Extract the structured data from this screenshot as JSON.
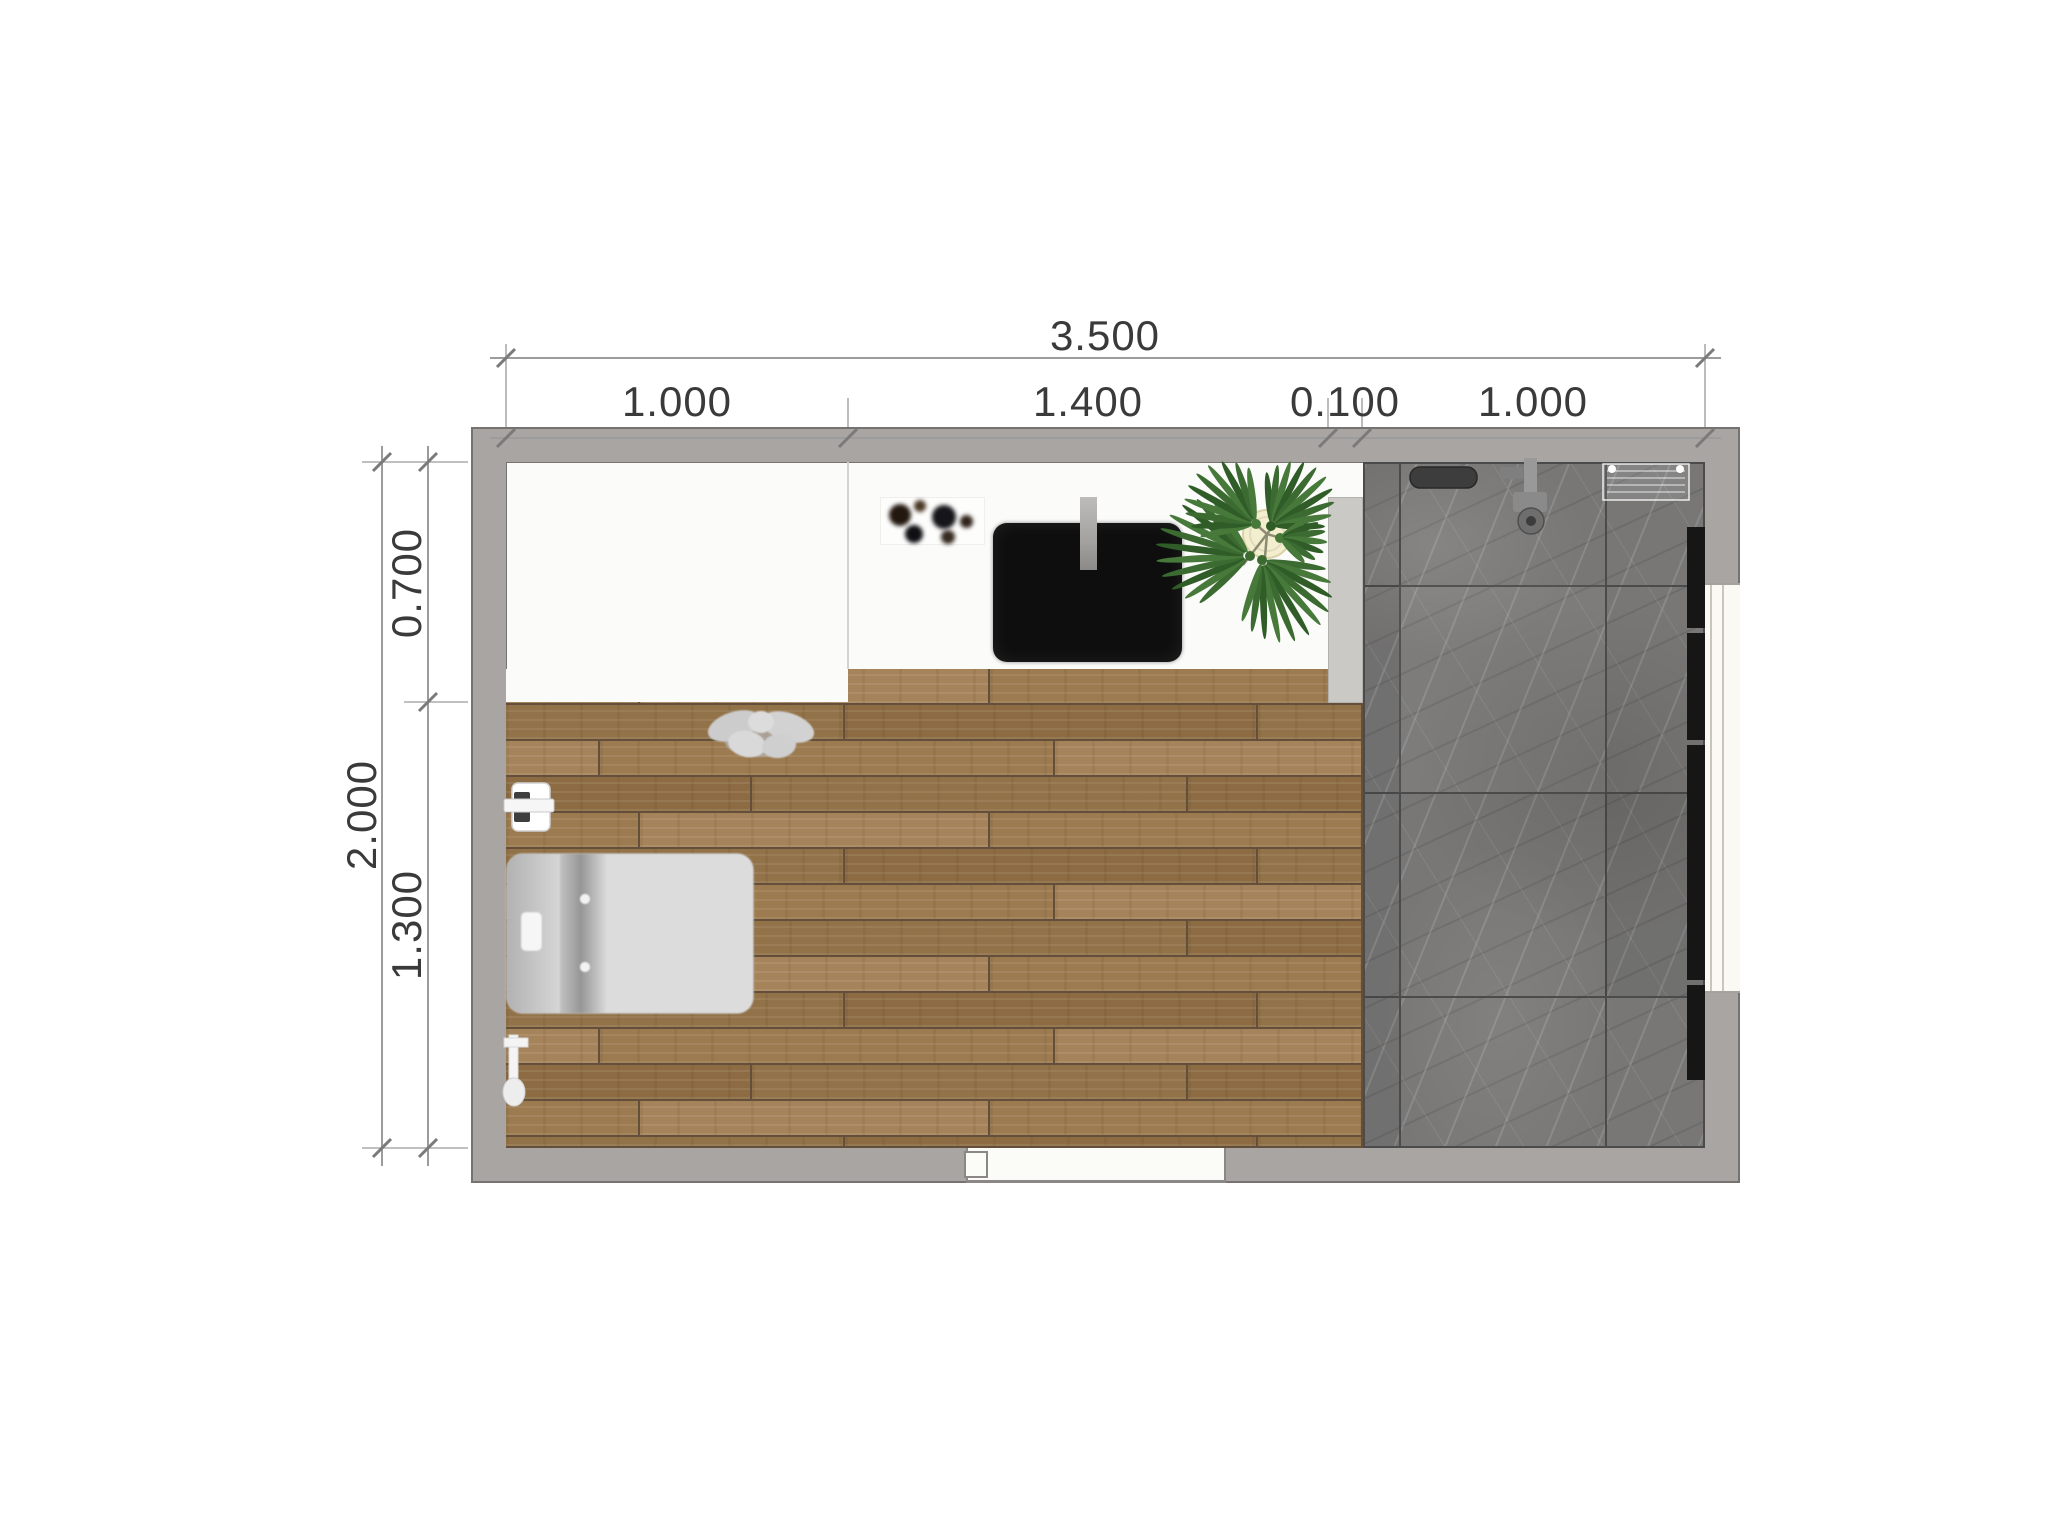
{
  "plan": {
    "type": "bathroom-floor-plan-top-view",
    "dimensions_top": {
      "total": "3.500",
      "seg1": "1.000",
      "seg2": "1.400",
      "seg3": "0.100",
      "seg4": "1.000"
    },
    "dimensions_left": {
      "total": "2.000",
      "seg1": "0.700",
      "seg2": "1.300"
    },
    "materials": {
      "wall_gray": "#a9a5a2",
      "wood_floor_brown": "#9c7b50",
      "marble_gray": "#787776",
      "partition_gray": "#cac9c6",
      "sink_black": "#0e0e0e",
      "plant_green": "#3c6b31",
      "pot_cream": "#f3eecd",
      "fixture_white": "#ececec"
    },
    "elements": [
      "outer-wall",
      "vanity-zone",
      "vanity-counter",
      "sink",
      "faucet",
      "decor-tray",
      "monstera-plant",
      "partition-wall",
      "marble-shower-floor",
      "shower-drain",
      "shower-valve",
      "shower-rack",
      "glass-strip",
      "window",
      "wood-floor",
      "towel",
      "toilet",
      "toilet-paper-holder",
      "toilet-brush",
      "door-opening"
    ]
  }
}
